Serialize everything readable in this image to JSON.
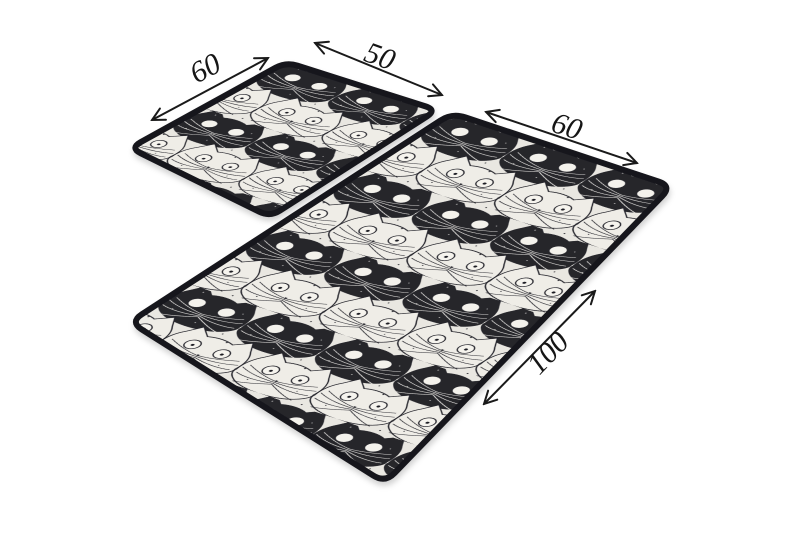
{
  "product": {
    "type": "rug set product photo",
    "pieces": "2",
    "pattern": "black-and-white cat faces"
  },
  "palette": {
    "page_background": "#ffffff",
    "cat_black": "#25252c",
    "rug_cream": "#e9e7e1",
    "cat_white": "#efede7",
    "eye_white": "#f4f2ec",
    "rug_border": "#17171b",
    "dimension_color": "#1a1a1a"
  },
  "dimensions": {
    "small_rug": {
      "side_label": "60",
      "front_label": "50"
    },
    "large_rug": {
      "front_label": "60",
      "side_label": "100"
    }
  }
}
